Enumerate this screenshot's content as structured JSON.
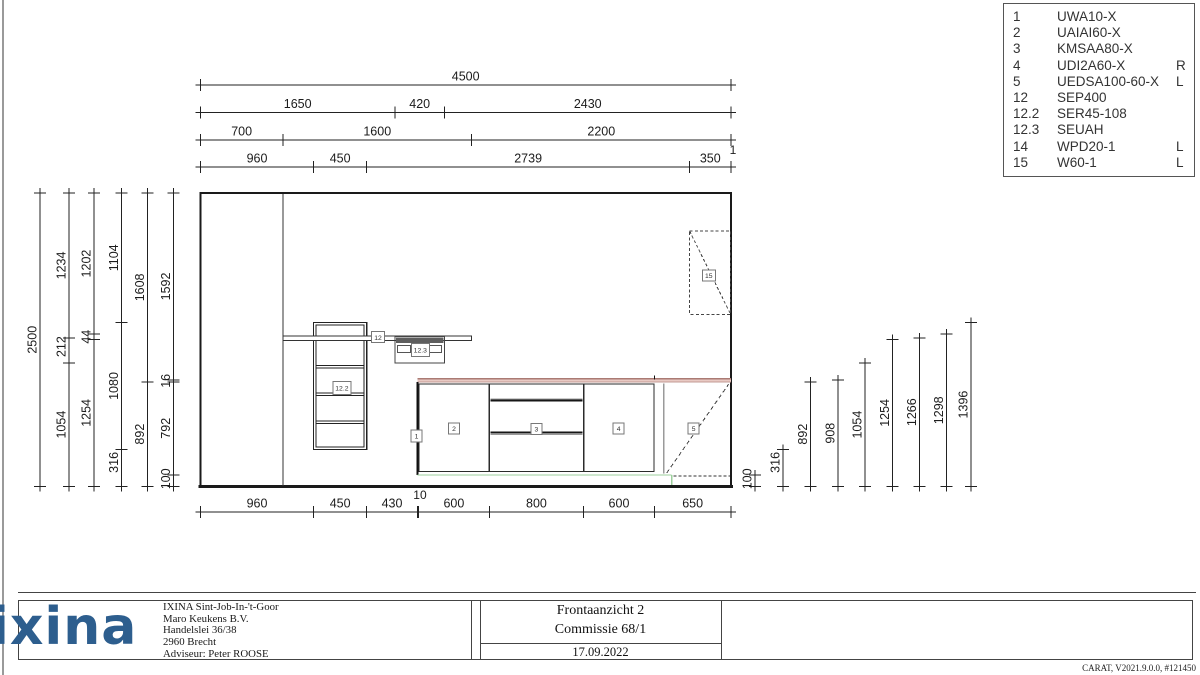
{
  "parts_list": {
    "rows": [
      {
        "no": "1",
        "code": "UWA10-X",
        "side": ""
      },
      {
        "no": "2",
        "code": "UAIAI60-X",
        "side": ""
      },
      {
        "no": "3",
        "code": "KMSAA80-X",
        "side": ""
      },
      {
        "no": "4",
        "code": "UDI2A60-X",
        "side": "R"
      },
      {
        "no": "5",
        "code": "UEDSA100-60-X",
        "side": "L"
      },
      {
        "no": "12",
        "code": "SEP400",
        "side": ""
      },
      {
        "no": "12.2",
        "code": "SER45-108",
        "side": ""
      },
      {
        "no": "12.3",
        "code": "SEUAH",
        "side": ""
      },
      {
        "no": "14",
        "code": "WPD20-1",
        "side": "L"
      },
      {
        "no": "15",
        "code": "W60-1",
        "side": "L"
      }
    ]
  },
  "dimensions": {
    "top_rows": [
      {
        "bounds": [
          0,
          4500
        ],
        "labels": [
          "4500"
        ],
        "raised": []
      },
      {
        "bounds": [
          0,
          1650,
          2070,
          4500
        ],
        "labels": [
          "1650",
          "420",
          "2430"
        ],
        "raised": []
      },
      {
        "bounds": [
          0,
          700,
          2300,
          4500
        ],
        "labels": [
          "700",
          "1600",
          "2200"
        ],
        "raised": []
      },
      {
        "bounds": [
          0,
          960,
          1410,
          4149,
          4499,
          4500
        ],
        "labels": [
          "960",
          "450",
          "2739",
          "350",
          "1"
        ],
        "raised": [
          4
        ]
      }
    ],
    "bottom_row": {
      "bounds": [
        0,
        960,
        1410,
        1840,
        1850,
        2450,
        3250,
        3850,
        4500
      ],
      "labels": [
        "960",
        "450",
        "430",
        "10",
        "600",
        "800",
        "600",
        "650"
      ],
      "raised": [
        3
      ]
    },
    "left_chains": [
      {
        "bounds": [
          0,
          2500
        ],
        "labels": [
          "2500"
        ]
      },
      {
        "bounds": [
          0,
          1054,
          1266,
          2500
        ],
        "labels": [
          "1054",
          "212",
          "1234"
        ]
      },
      {
        "bounds": [
          0,
          1254,
          1298,
          2500
        ],
        "labels": [
          "1254",
          "44",
          "1202"
        ]
      },
      {
        "bounds": [
          0,
          316,
          1396,
          2500
        ],
        "labels": [
          "316",
          "1080",
          "1104"
        ]
      },
      {
        "bounds": [
          0,
          892,
          2500
        ],
        "labels": [
          "892",
          "1608"
        ]
      },
      {
        "bounds": [
          0,
          100,
          892,
          908,
          2500
        ],
        "labels": [
          "100",
          "792",
          "16",
          "1592"
        ]
      }
    ],
    "right_dims": [
      "100",
      "316",
      "892",
      "908",
      "1054",
      "1254",
      "1266",
      "1298",
      "1396"
    ]
  },
  "drawing_labels": [
    "1",
    "2",
    "3",
    "4",
    "5",
    "12",
    "12.2",
    "12.3",
    "15"
  ],
  "title_block": {
    "company_lines": [
      "IXINA Sint-Job-In-'t-Goor",
      "Maro Keukens B.V.",
      "Handelslei 36/38",
      "2960 Brecht",
      "Adviseur: Peter ROOSE"
    ],
    "drawing_title": "Frontaanzicht 2",
    "commission": "Commissie 68/1",
    "date": "17.09.2022"
  },
  "logo": {
    "text": "ixina",
    "color": "#2d5e8e"
  },
  "footer": {
    "credit": "CARAT, V2021.9.0.0, #121450"
  },
  "colors": {
    "line": "#1a1a1a",
    "dim_text": "#1c1c1c",
    "worktop_fill": "#e9cac4",
    "worktop_edge": "#aa7b74",
    "worktop_edge2": "#c39b94",
    "plinth_green": "#9ccf9c",
    "panel_gray": "#9a9a9a",
    "label_border": "#777777",
    "dark_bar": "#5e5e5e"
  }
}
